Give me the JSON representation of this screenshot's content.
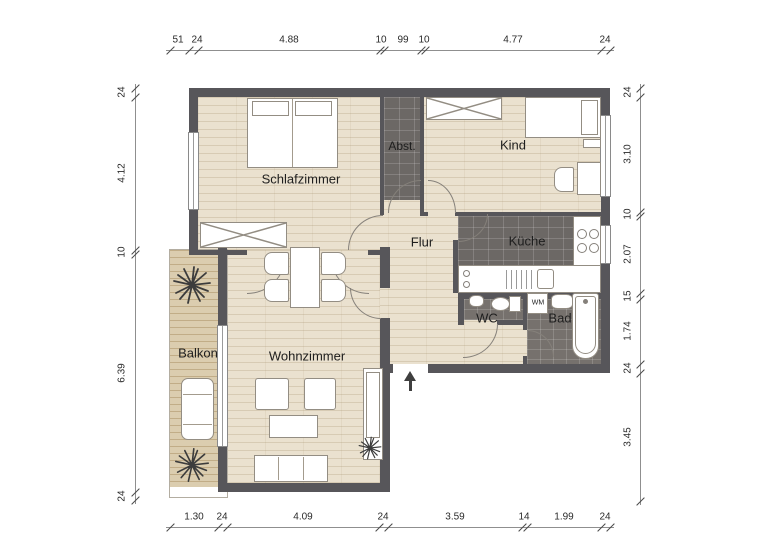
{
  "rooms": {
    "schlafzimmer": "Schlafzimmer",
    "abstellraum": "Abst.",
    "kind": "Kind",
    "flur": "Flur",
    "kueche": "Küche",
    "wc": "WC",
    "bad": "Bad",
    "wohnzimmer": "Wohnzimmer",
    "balkon": "Balkon",
    "waschmaschine": "WM"
  },
  "dimensions": {
    "top": [
      "51",
      "24",
      "4.88",
      "10",
      "99",
      "10",
      "4.77",
      "24"
    ],
    "bottom": [
      "1.30",
      "24",
      "4.09",
      "24",
      "3.59",
      "14",
      "1.99",
      "24"
    ],
    "left": [
      "24",
      "4.12",
      "10",
      "6.39",
      "24"
    ],
    "right": [
      "24",
      "3.10",
      "10",
      "2.07",
      "15",
      "1.74",
      "24",
      "3.45"
    ]
  },
  "colors": {
    "wall": "#57565a",
    "kitchen_tile": "#6c6865",
    "bath_tile": "#76716d",
    "wood_floor": "#eae1cf",
    "balcony_floor": "#dbcdaf"
  }
}
